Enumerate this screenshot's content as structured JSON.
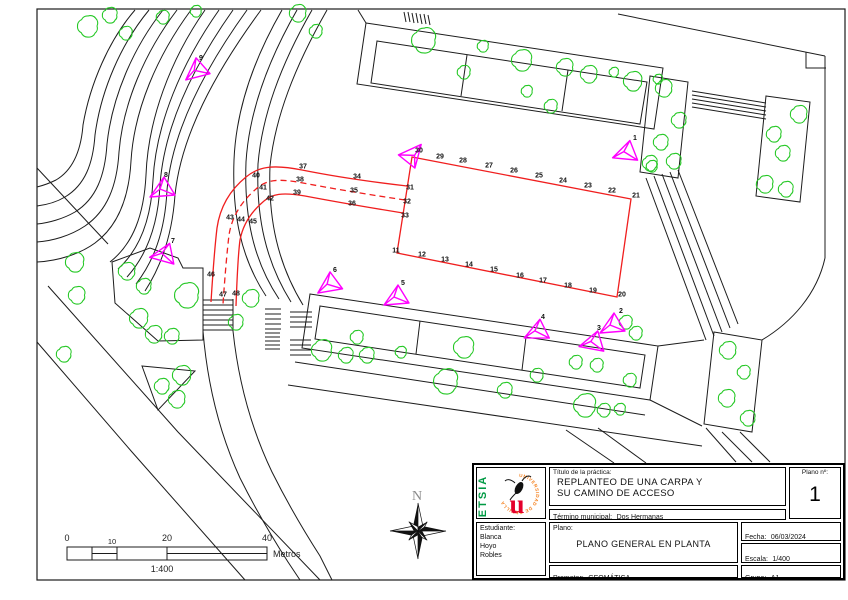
{
  "title_block": {
    "practice_label": "Título de la práctica:",
    "practice_title_line1": "REPLANTEO DE UNA CARPA Y",
    "practice_title_line2": "SU CAMINO DE ACCESO",
    "plan_number_label": "Plano nº:",
    "plan_number": "1",
    "municipality_label": "Término municipal:",
    "municipality": "Dos Hermanas",
    "student_label": "Estudiante:",
    "student_lines": [
      "Blanca",
      "Hoyo",
      "Robles"
    ],
    "plan_label": "Plano:",
    "plan_name": "PLANO GENERAL EN PLANTA",
    "date_label": "Fecha:",
    "date": "06/03/2024",
    "scale_label": "Escala:",
    "scale": "1/400",
    "promoter_label": "Promotor:",
    "promoter": "GEOMÁTICA",
    "group_label": "Grupo:",
    "group": "A1",
    "logo": {
      "school": "ETSIA",
      "university_ring": "UNIVERSIDAD DE SEVILLA",
      "letter": "u"
    }
  },
  "scale_bar": {
    "ticks": [
      "0",
      "10",
      "20",
      "40"
    ],
    "unit": "Metros",
    "ratio": "1:400"
  },
  "north_label": "N",
  "plan": {
    "stations": [
      {
        "label": "1",
        "x": 626,
        "y": 151,
        "rot": 10,
        "lx": 635,
        "ly": 140
      },
      {
        "label": "2",
        "x": 612,
        "y": 324,
        "rot": 0,
        "lx": 621,
        "ly": 313
      },
      {
        "label": "3",
        "x": 593,
        "y": 341,
        "rot": 15,
        "lx": 599,
        "ly": 330
      },
      {
        "label": "4",
        "x": 537,
        "y": 330,
        "rot": 5,
        "lx": 543,
        "ly": 319
      },
      {
        "label": "5",
        "x": 396,
        "y": 296,
        "rot": 0,
        "lx": 403,
        "ly": 285
      },
      {
        "label": "6",
        "x": 329,
        "y": 283,
        "rot": -5,
        "lx": 335,
        "ly": 272
      },
      {
        "label": "7",
        "x": 164,
        "y": 253,
        "rot": 20,
        "lx": 173,
        "ly": 243
      },
      {
        "label": "8",
        "x": 162,
        "y": 188,
        "rot": 0,
        "lx": 166,
        "ly": 177
      },
      {
        "label": "9",
        "x": 196,
        "y": 69,
        "rot": -10,
        "lx": 201,
        "ly": 60
      },
      {
        "label": "",
        "x": 413,
        "y": 157,
        "rot": 160,
        "lx": 0,
        "ly": 0
      }
    ],
    "points": [
      {
        "label": "11",
        "x": 396,
        "y": 250
      },
      {
        "label": "12",
        "x": 422,
        "y": 254
      },
      {
        "label": "13",
        "x": 445,
        "y": 259
      },
      {
        "label": "14",
        "x": 469,
        "y": 264
      },
      {
        "label": "15",
        "x": 494,
        "y": 269
      },
      {
        "label": "16",
        "x": 520,
        "y": 275
      },
      {
        "label": "17",
        "x": 543,
        "y": 280
      },
      {
        "label": "18",
        "x": 568,
        "y": 285
      },
      {
        "label": "19",
        "x": 593,
        "y": 290
      },
      {
        "label": "20",
        "x": 622,
        "y": 294
      },
      {
        "label": "21",
        "x": 636,
        "y": 195
      },
      {
        "label": "22",
        "x": 612,
        "y": 190
      },
      {
        "label": "23",
        "x": 588,
        "y": 185
      },
      {
        "label": "24",
        "x": 563,
        "y": 180
      },
      {
        "label": "25",
        "x": 539,
        "y": 175
      },
      {
        "label": "26",
        "x": 514,
        "y": 170
      },
      {
        "label": "27",
        "x": 489,
        "y": 165
      },
      {
        "label": "28",
        "x": 463,
        "y": 160
      },
      {
        "label": "29",
        "x": 440,
        "y": 156
      },
      {
        "label": "30",
        "x": 419,
        "y": 150
      },
      {
        "label": "31",
        "x": 410,
        "y": 187
      },
      {
        "label": "32",
        "x": 407,
        "y": 201
      },
      {
        "label": "33",
        "x": 405,
        "y": 215
      },
      {
        "label": "34",
        "x": 357,
        "y": 176
      },
      {
        "label": "35",
        "x": 354,
        "y": 190
      },
      {
        "label": "36",
        "x": 352,
        "y": 203
      },
      {
        "label": "37",
        "x": 303,
        "y": 166
      },
      {
        "label": "38",
        "x": 300,
        "y": 179
      },
      {
        "label": "39",
        "x": 297,
        "y": 192
      },
      {
        "label": "40",
        "x": 256,
        "y": 175
      },
      {
        "label": "41",
        "x": 263,
        "y": 187
      },
      {
        "label": "42",
        "x": 270,
        "y": 198
      },
      {
        "label": "43",
        "x": 230,
        "y": 217
      },
      {
        "label": "44",
        "x": 241,
        "y": 219
      },
      {
        "label": "45",
        "x": 253,
        "y": 221
      },
      {
        "label": "46",
        "x": 211,
        "y": 274
      },
      {
        "label": "47",
        "x": 223,
        "y": 294
      },
      {
        "label": "48",
        "x": 236,
        "y": 293
      }
    ]
  },
  "colors": {
    "linework": "#1c1c1c",
    "stakeout_red": "#f01e1e",
    "station_magenta": "#ff00ff",
    "tree_green": "#25c825",
    "north_gray": "#8a8a8a",
    "logo_green": "#009a44",
    "logo_orange": "#f58220",
    "logo_red": "#e4002b"
  }
}
